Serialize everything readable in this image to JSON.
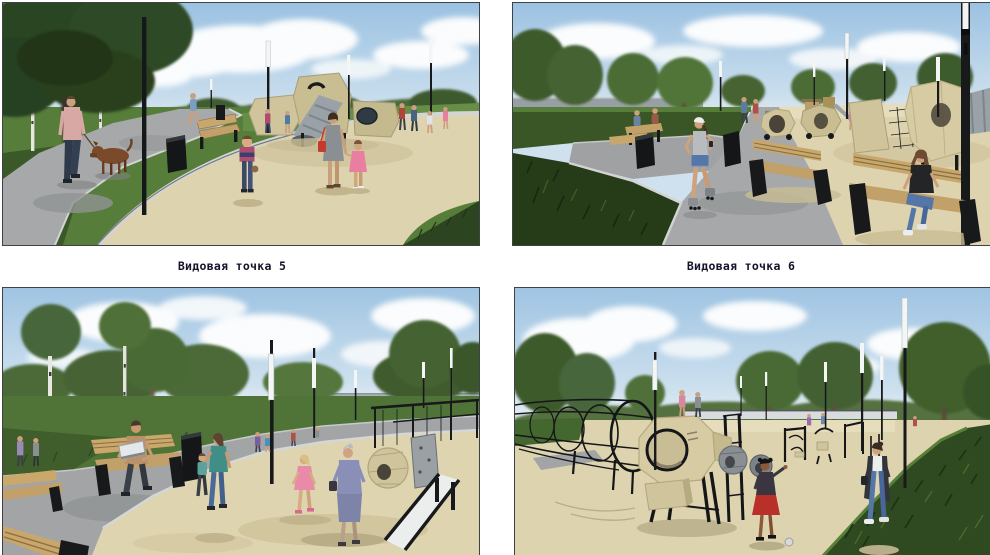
{
  "panels": [
    {
      "name": "viewpoint-5",
      "caption": "Видовая точка 5",
      "alt": "Park render: man walking a brown dog on a grey curving path, birch trees, benches, litter bins, lamp posts, beige playground plaza with tube-slide play structure, toddler, woman with girl"
    },
    {
      "name": "viewpoint-6",
      "caption": "Видовая точка 6",
      "alt": "Park render: girl rollerblading on grey path, dark lawn with trees at left, wooden benches with seated woman, beige play area with hexagonal pods and grey tube, tall lamp post"
    },
    {
      "name": "viewpoint-7",
      "alt": "Park render: man with laptop on wooden bench, woman with child on grey path, elderly woman talking to girl on beige plaza, slide and play pods, lamp posts with white tubes"
    },
    {
      "name": "viewpoint-8",
      "alt": "Park render: black rope climbing tunnel, beige play pod on black stilts, fitness equipment, girl in red skirt, walking woman, tall lamp posts, dark lawn at right"
    }
  ],
  "colors": {
    "page_background": "#ffffff",
    "caption_text": "#14142b",
    "panel_border": "#3f4245",
    "sky_blue": "#a7cae6",
    "cloud_white": "#f9fbfd",
    "grass_green": "#4f7636",
    "grass_dark": "#2c441f",
    "path_gray": "#a6a8a9",
    "plaza_beige": "#ddd3ae",
    "equipment_beige": "#cfc49c",
    "tube_gray": "#9aa2a8",
    "bench_wood": "#c8a76c",
    "metal_black": "#17191b",
    "lamp_white": "#f4f6f6",
    "accent_red": "#c23b2e",
    "denim_blue": "#5577a8"
  }
}
